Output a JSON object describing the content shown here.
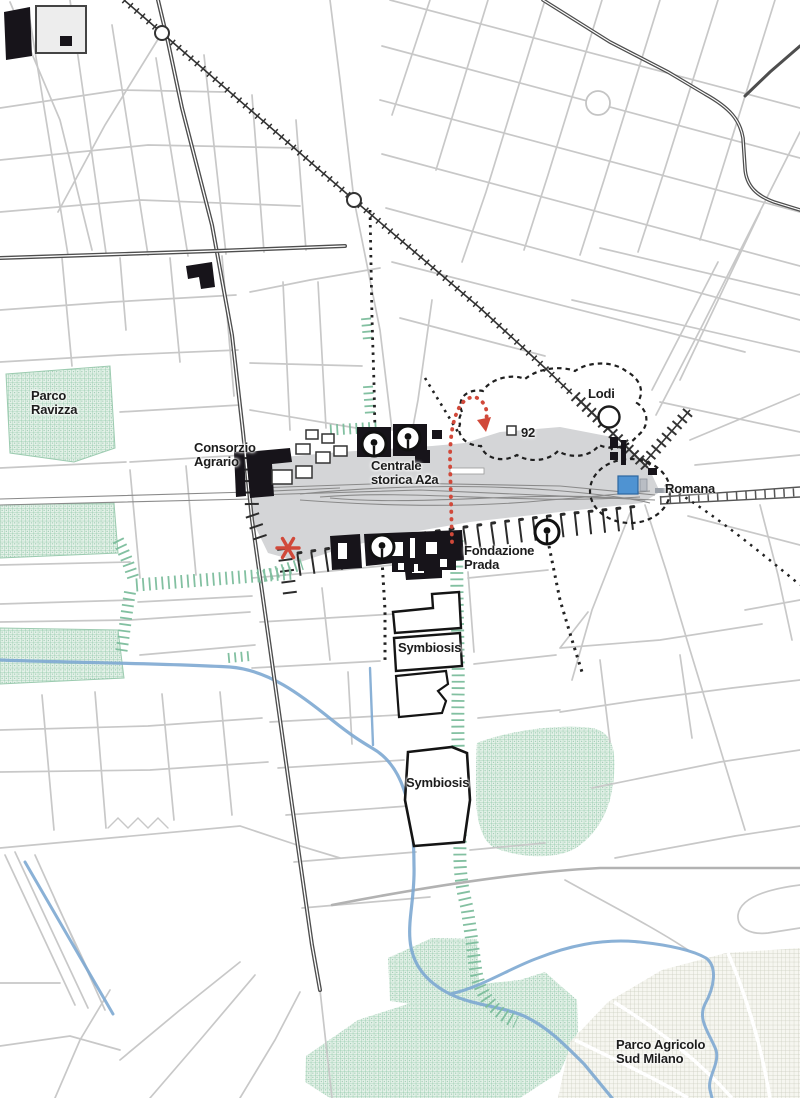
{
  "labels": {
    "parco_ravizza": "Parco\nRavizza",
    "consorzio_agrario": "Consorzio\nAgrario",
    "centrale_storica_a2a": "Centrale\nstorica A2a",
    "lodi": "Lodi",
    "stop_92": "92",
    "romana": "Romana",
    "fondazione_prada": "Fondazione\nPrada",
    "symbiosis_north": "Symbiosis",
    "symbiosis_south": "Symbiosis",
    "parco_agricolo_sud_milano": "Parco Agricolo\nSud Milano"
  },
  "icons": {
    "lodi_station_circle": "metro-station-ring",
    "romana_station_square": "blue-station-square",
    "stop_92_square": "small-outlined-square",
    "site_pin": "circled-pin-marker-x4",
    "red_asterisk": "red-asterisk-highlight",
    "red_loop_arrow": "red-dotted-u-turn-arrow"
  },
  "colors": {
    "park_green": "#7cbd9c",
    "rail_yard_gray": "#d4d5d7",
    "water_blue": "#7ea9d2",
    "accent_red": "#d1493a",
    "station_blue": "#4f93d2",
    "ink": "#1d1d1d",
    "street_gray": "#c8c8c8"
  }
}
